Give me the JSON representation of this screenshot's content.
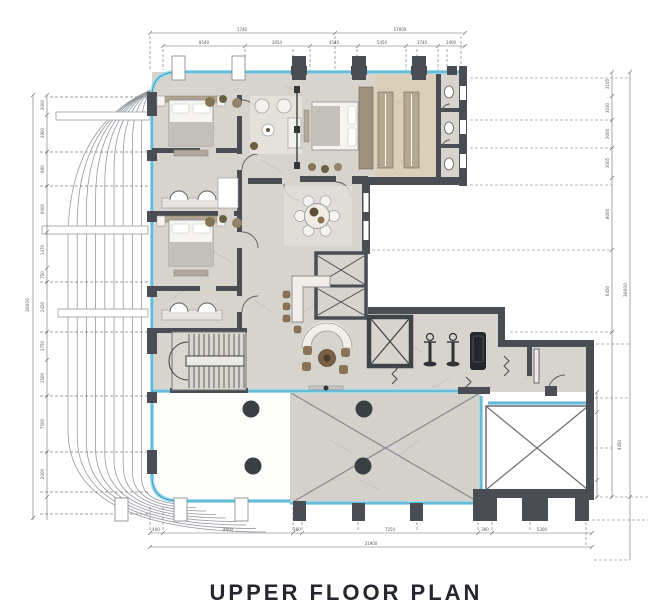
{
  "title": {
    "text": "UPPER FLOOR PLAN"
  },
  "dimensions": {
    "top1": [
      "1740",
      "17000"
    ],
    "top2": [
      "8540",
      "3054",
      "4540",
      "5450",
      "3740",
      "1400"
    ],
    "bottom1": [
      "400",
      "4600",
      "380",
      "7250",
      "380",
      "5300"
    ],
    "bottom_total": "31900",
    "left": [
      "3000",
      "3900",
      "800",
      "6000",
      "1470",
      "750",
      "2450",
      "3750",
      "1500",
      "7500",
      "2000"
    ],
    "left_total": "30000",
    "right": [
      "3105",
      "3030",
      "3000",
      "3005",
      "8000",
      "6450"
    ],
    "right_total": "30000",
    "right_lower": [
      "900",
      "8150"
    ],
    "right_lower_total": "9450"
  },
  "colors": {
    "wall": "#4a4e54",
    "glazing": "#2f9fc4",
    "glazing_light": "#9ed8ea",
    "floor": "#d7d3cd",
    "floor_beige": "#dccfba",
    "wardrobe": "#b6a78f",
    "furniture_brown": "#8a7357",
    "accent_dark": "#33373c",
    "dimension_line": "#6a6d70",
    "title": "#26262e"
  }
}
